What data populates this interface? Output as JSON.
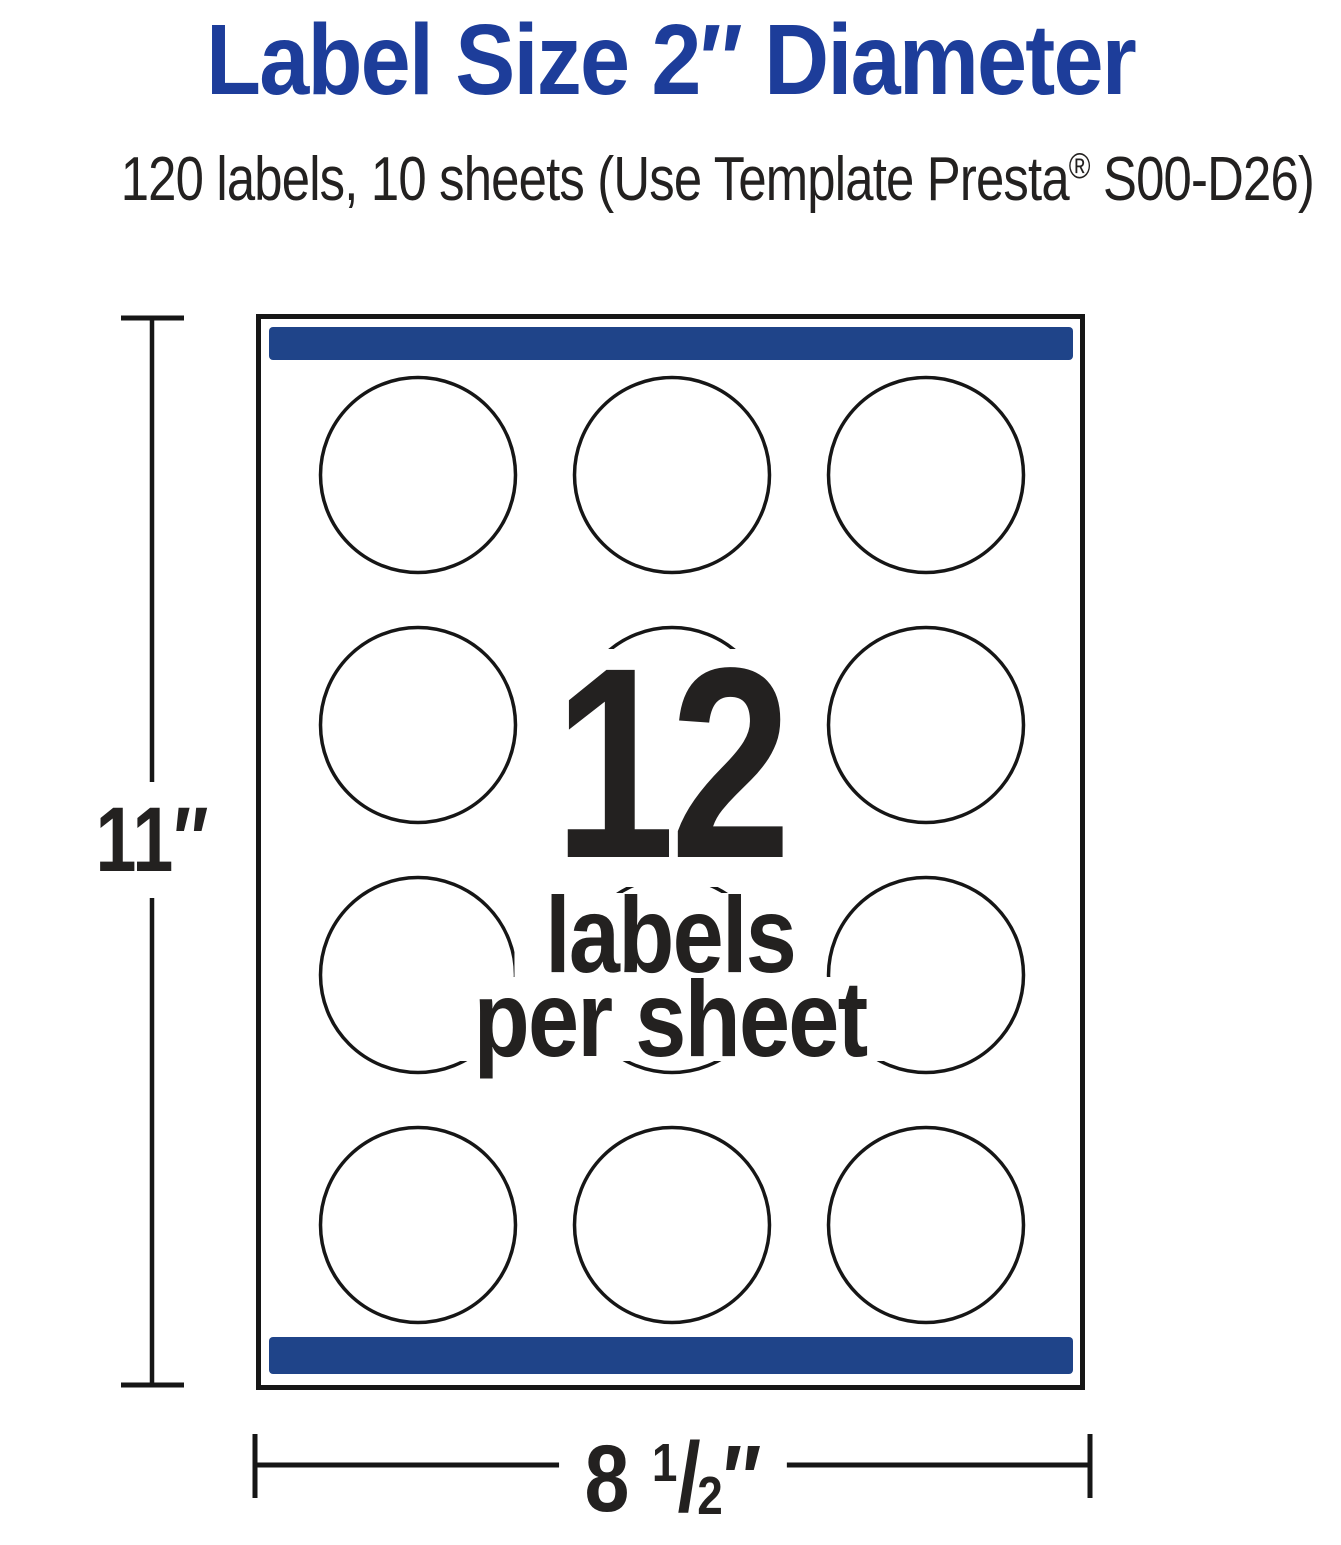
{
  "header": {
    "title": "Label Size 2″ Diameter",
    "subtitle": {
      "before": "120 labels, 10 sheets (Use Template Presta",
      "reg_mark": "®",
      "after": " S00-D26)"
    }
  },
  "sheet": {
    "labels_per_sheet_number": "12",
    "labels_word": "labels",
    "per_sheet_words": "per sheet",
    "grid": {
      "rows": 4,
      "columns": 3,
      "circle_count": 12
    }
  },
  "dimensions": {
    "height": "11″",
    "width": {
      "whole": "8",
      "numerator": "1",
      "fraction_slash": "/",
      "denominator": "2",
      "unit": "″"
    }
  },
  "colors": {
    "title-blue": "#1d3d9a",
    "bar-blue": "#1f4489",
    "ink": "#232120",
    "line": "#161616"
  }
}
